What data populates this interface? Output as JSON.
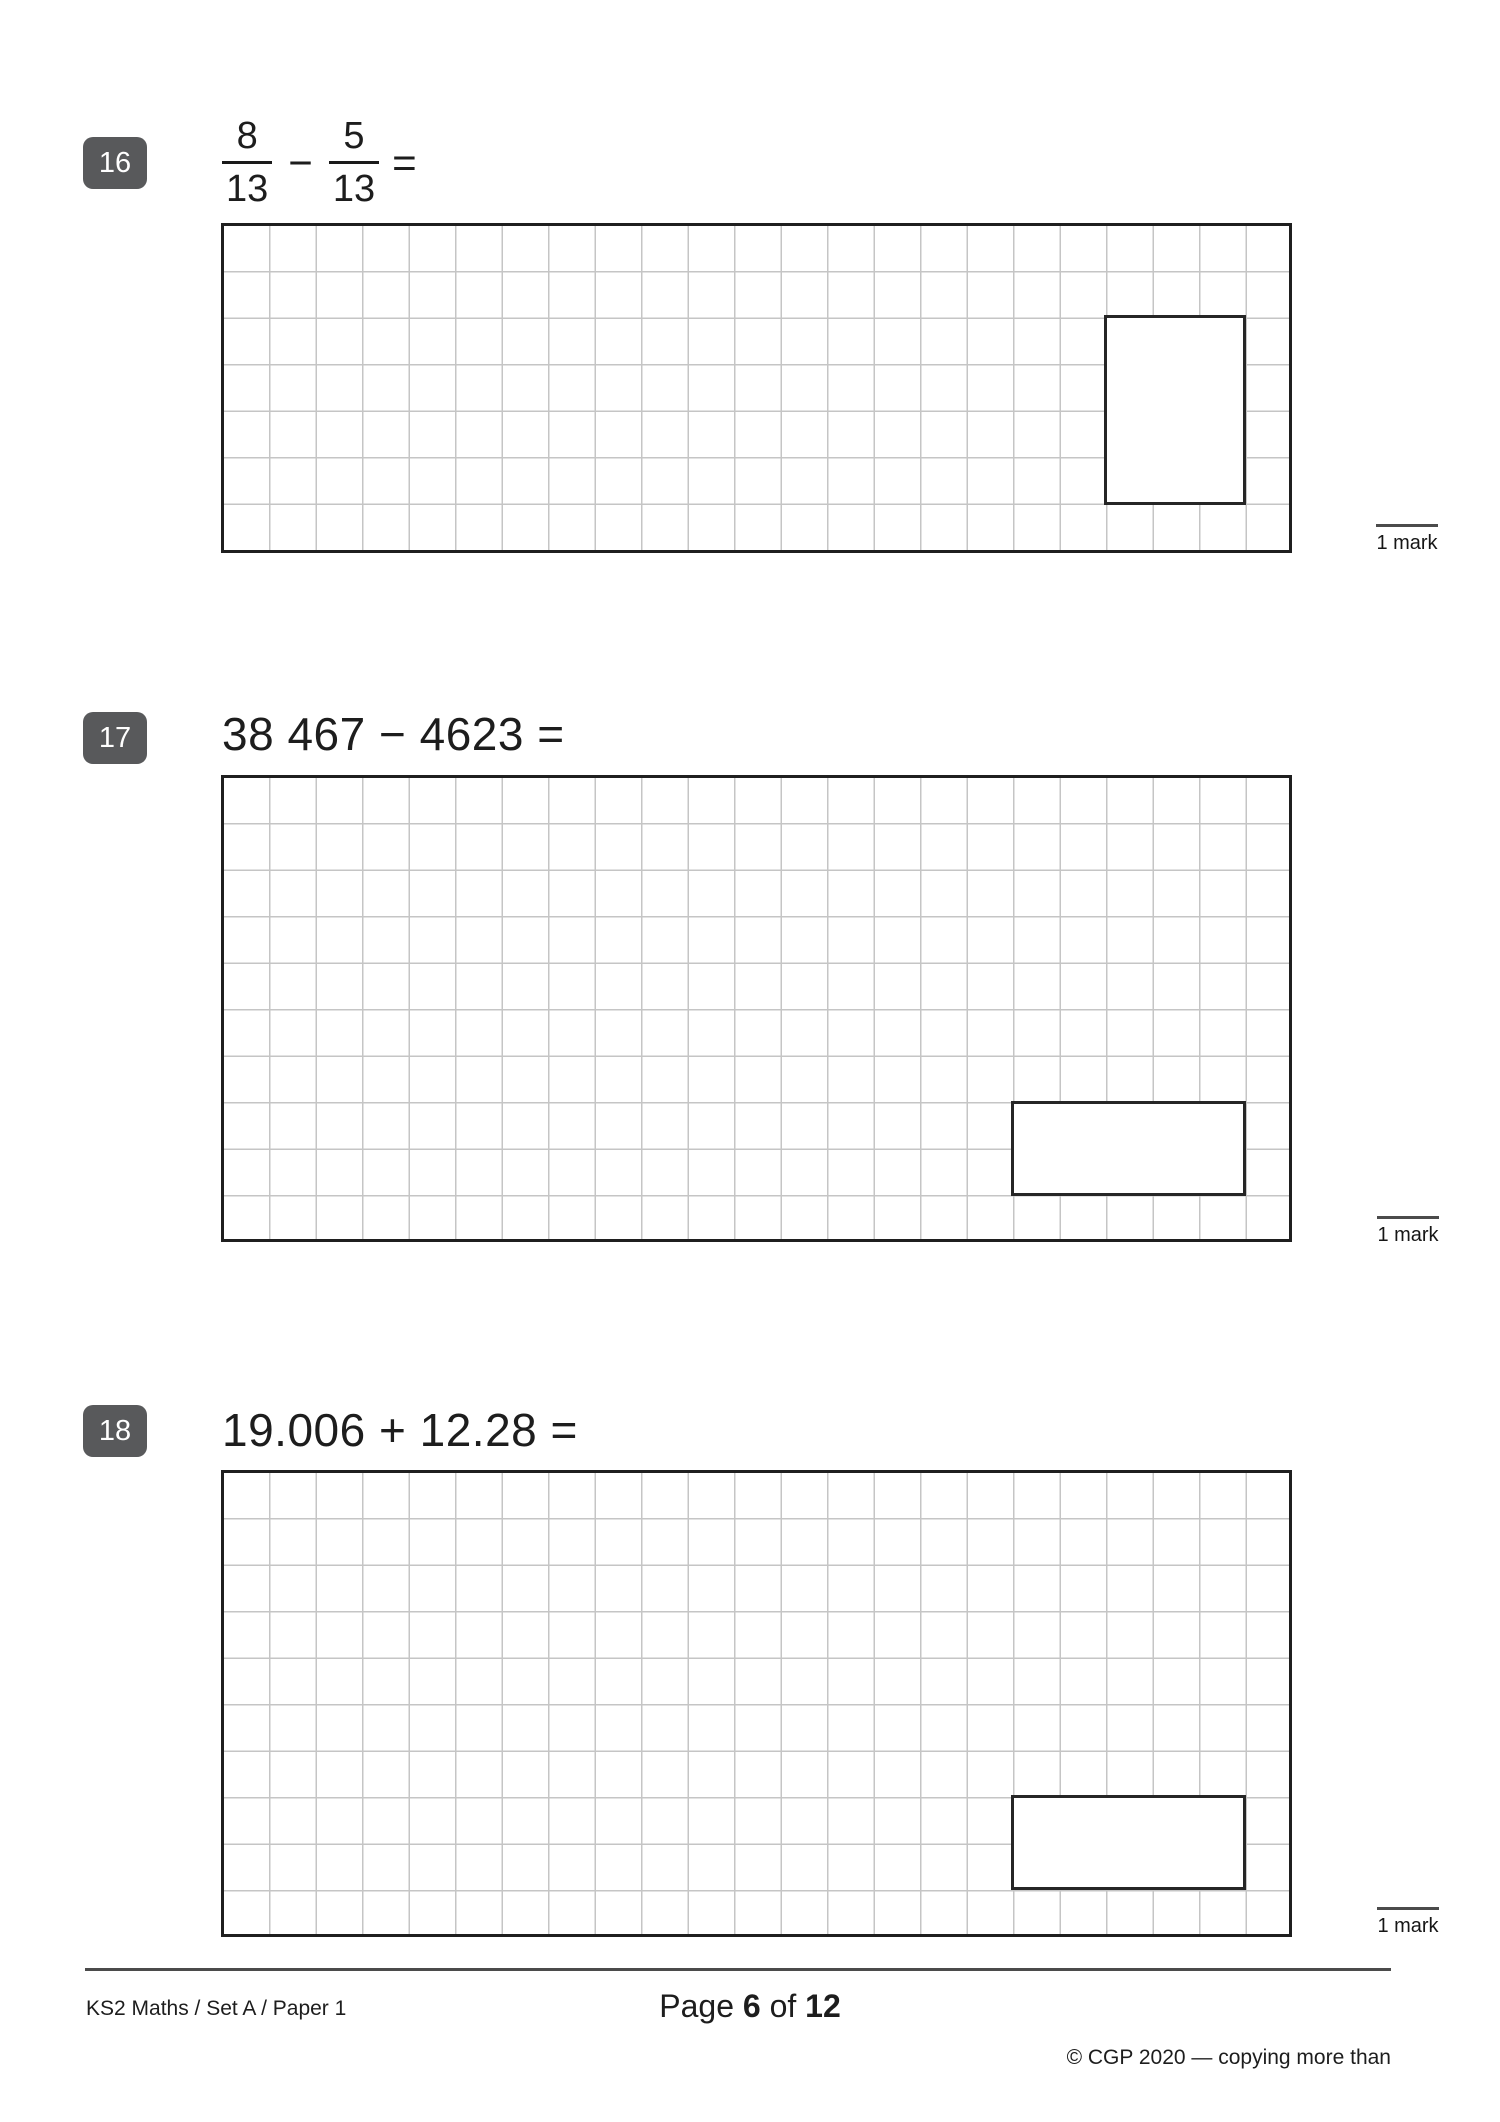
{
  "questions": [
    {
      "number": "16",
      "fraction": {
        "num1": "8",
        "den1": "13",
        "operator": "−",
        "num2": "5",
        "den2": "13",
        "equals": "="
      },
      "mark_label": "1 mark"
    },
    {
      "number": "17",
      "equation": "38 467 − 4623 =",
      "mark_label": "1 mark"
    },
    {
      "number": "18",
      "equation": "19.006 + 12.28 =",
      "mark_label": "1 mark"
    }
  ],
  "footer": {
    "doc_ref": "KS2 Maths / Set A / Paper 1",
    "page_word": "Page ",
    "page_num": "6",
    "of_word": " of ",
    "total_num": "12",
    "copyright_line1": "© CGP 2020 — copying more than",
    "copyright_line2": "5% of this paper is not permitted"
  },
  "colors": {
    "badge_bg": "#58595b",
    "grid_line": "#c5c5c5",
    "grid_border": "#1f1f1f",
    "text": "#1d1d1d",
    "rule": "#4b4b4b"
  }
}
